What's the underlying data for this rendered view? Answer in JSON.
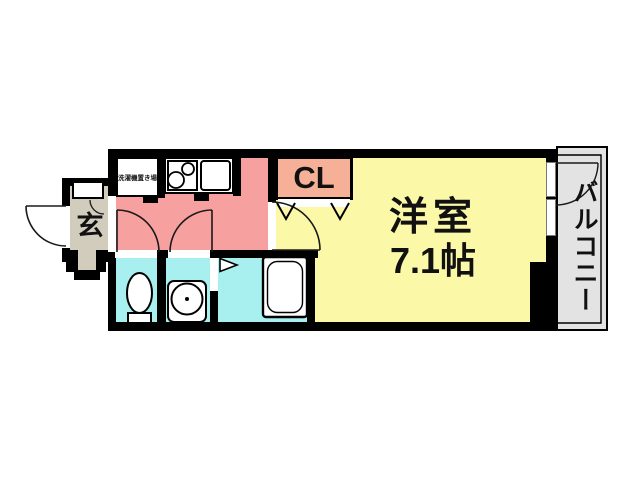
{
  "floorplan": {
    "labels": {
      "western_room": "洋室",
      "western_room_size": "7.1帖",
      "closet": "CL",
      "entrance": "玄",
      "balcony": "バルコニー",
      "washer_space": "洗濯機置き場"
    },
    "colors": {
      "wall_black": "#000000",
      "hall_kitchen_pink": "#f7a0a0",
      "western_room_yellow": "#fbf8a8",
      "closet_salmon": "#f6b097",
      "wet_area_cyan": "#a8f0f0",
      "entrance_beige": "#d2ccbd",
      "balcony_gray": "#e3e3e3"
    }
  }
}
